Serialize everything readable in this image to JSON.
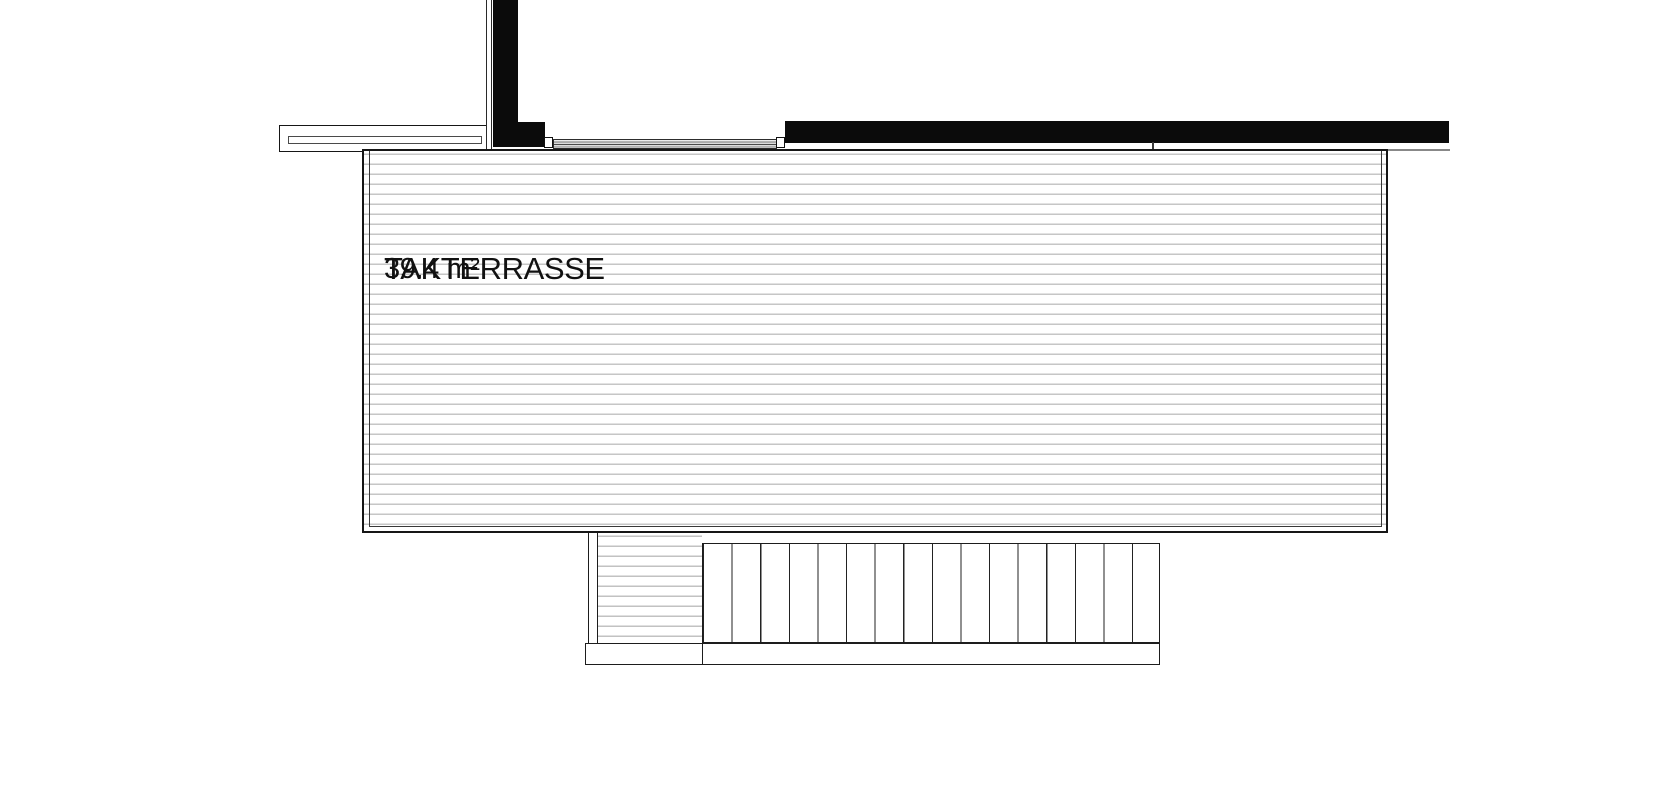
{
  "plan": {
    "title": "roof terrace floor plan",
    "room_label": "TAKTERRASSE",
    "area_label": "39.4 m²",
    "stair_tread_count": 16,
    "colors": {
      "background": "#ffffff",
      "wall_fill": "#0b0b0b",
      "outline": "#1d1d1d",
      "deck_hatch": "#c6c6c6",
      "label_text": "#111111"
    }
  }
}
